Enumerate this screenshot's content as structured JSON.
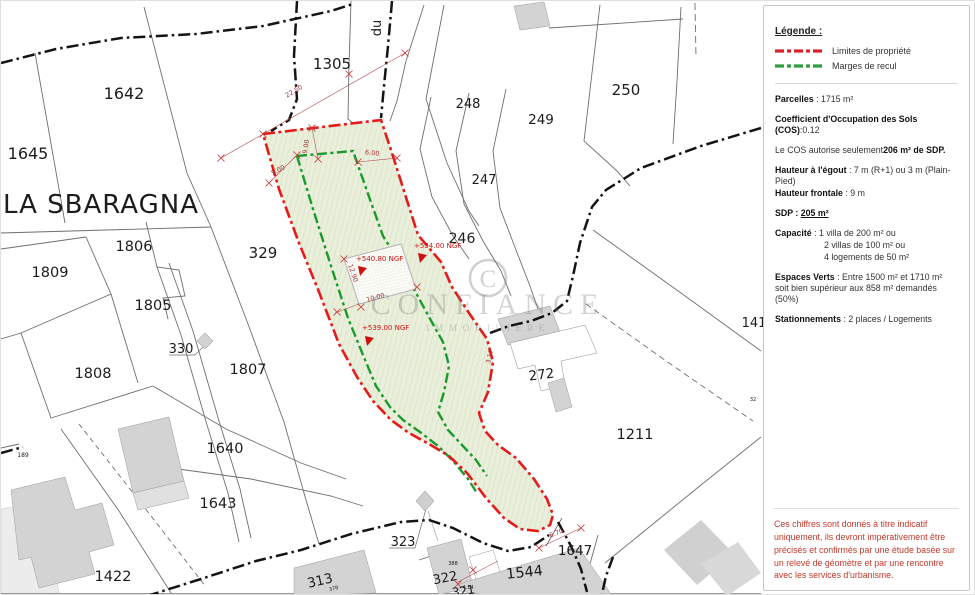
{
  "panel": {
    "legend": {
      "title": "Légende :",
      "items": [
        {
          "label": "Limites de propriété",
          "color": "#d8232a"
        },
        {
          "label": "Marges de recul",
          "color": "#2f9e41"
        }
      ]
    },
    "parcelles_label": "Parcelles",
    "parcelles_value": " : 1715 m²",
    "cos_label": "Coefficient d'Occupation des Sols (COS)",
    "cos_value": ":0.12",
    "cos_note_normal": "Le COS autorise seulement",
    "cos_note_bold": "206 m² de SDP.",
    "hauteur_egout_label": "Hauteur à l'égout",
    "hauteur_egout_value": " : 7 m (R+1) ou 3 m (Plain-Pied)",
    "hauteur_frontale_label": "Hauteur frontale",
    "hauteur_frontale_value": " : 9 m",
    "sdp_label": "SDP : ",
    "sdp_value": "205 m²",
    "capacite_label": "Capacité",
    "capacite_line1": " : 1 villa de 200 m² ou",
    "capacite_line2": "2 villas de 100 m² ou",
    "capacite_line3": "4 logements de 50 m²",
    "espaces_label": "Espaces Verts",
    "espaces_value": " : Entre 1500 m² et 1710 m² soit bien supérieur aux 858 m² demandés (50%)",
    "stationnements_label": "Stationnements",
    "stationnements_value": " : 2 places / Logements",
    "note": "Ces chiffres sont donnés à titre indicatif uniquement, ils devront impérativement être précisés et confirmés par une étude basée sur un relevé de géomètre et par une rencontre avec les services d'urbanisme."
  },
  "map": {
    "place": "LA SBARAGNA",
    "street": "du",
    "labels": [
      {
        "text": "1642"
      },
      {
        "text": "1645"
      },
      {
        "text": "1305"
      },
      {
        "text": "248"
      },
      {
        "text": "249"
      },
      {
        "text": "250"
      },
      {
        "text": "247"
      },
      {
        "text": "246"
      },
      {
        "text": "329"
      },
      {
        "text": "1806"
      },
      {
        "text": "1809"
      },
      {
        "text": "1805"
      },
      {
        "text": "330"
      },
      {
        "text": "1808"
      },
      {
        "text": "1807"
      },
      {
        "text": "1640"
      },
      {
        "text": "1643"
      },
      {
        "text": "1422"
      },
      {
        "text": "189"
      },
      {
        "text": "313"
      },
      {
        "text": "323"
      },
      {
        "text": "322"
      },
      {
        "text": "1544"
      },
      {
        "text": "1647"
      },
      {
        "text": "272"
      },
      {
        "text": "1211"
      },
      {
        "text": "141"
      },
      {
        "text": "321"
      },
      {
        "text": "378"
      },
      {
        "text": "388"
      },
      {
        "text": "4.14"
      },
      {
        "text": "32"
      }
    ],
    "dims": [
      {
        "text": "22.50"
      },
      {
        "text": "9.00"
      },
      {
        "text": "6.00"
      },
      {
        "text": "5.00"
      },
      {
        "text": "6.70"
      },
      {
        "text": "12.90"
      },
      {
        "text": "10.00"
      },
      {
        "text": "3.17"
      }
    ],
    "ngf": [
      {
        "text": "+540.80 NGF"
      },
      {
        "text": "+534.00 NGF"
      },
      {
        "text": "+539.00 NGF"
      }
    ],
    "watermark": {
      "initial": "C",
      "name": "CONFIANCE",
      "subtitle": "IMMOBILIERE"
    },
    "colors": {
      "boundary": "#e51b1b",
      "margin": "#199a2e",
      "parcel_fill": "#e9efda"
    }
  }
}
